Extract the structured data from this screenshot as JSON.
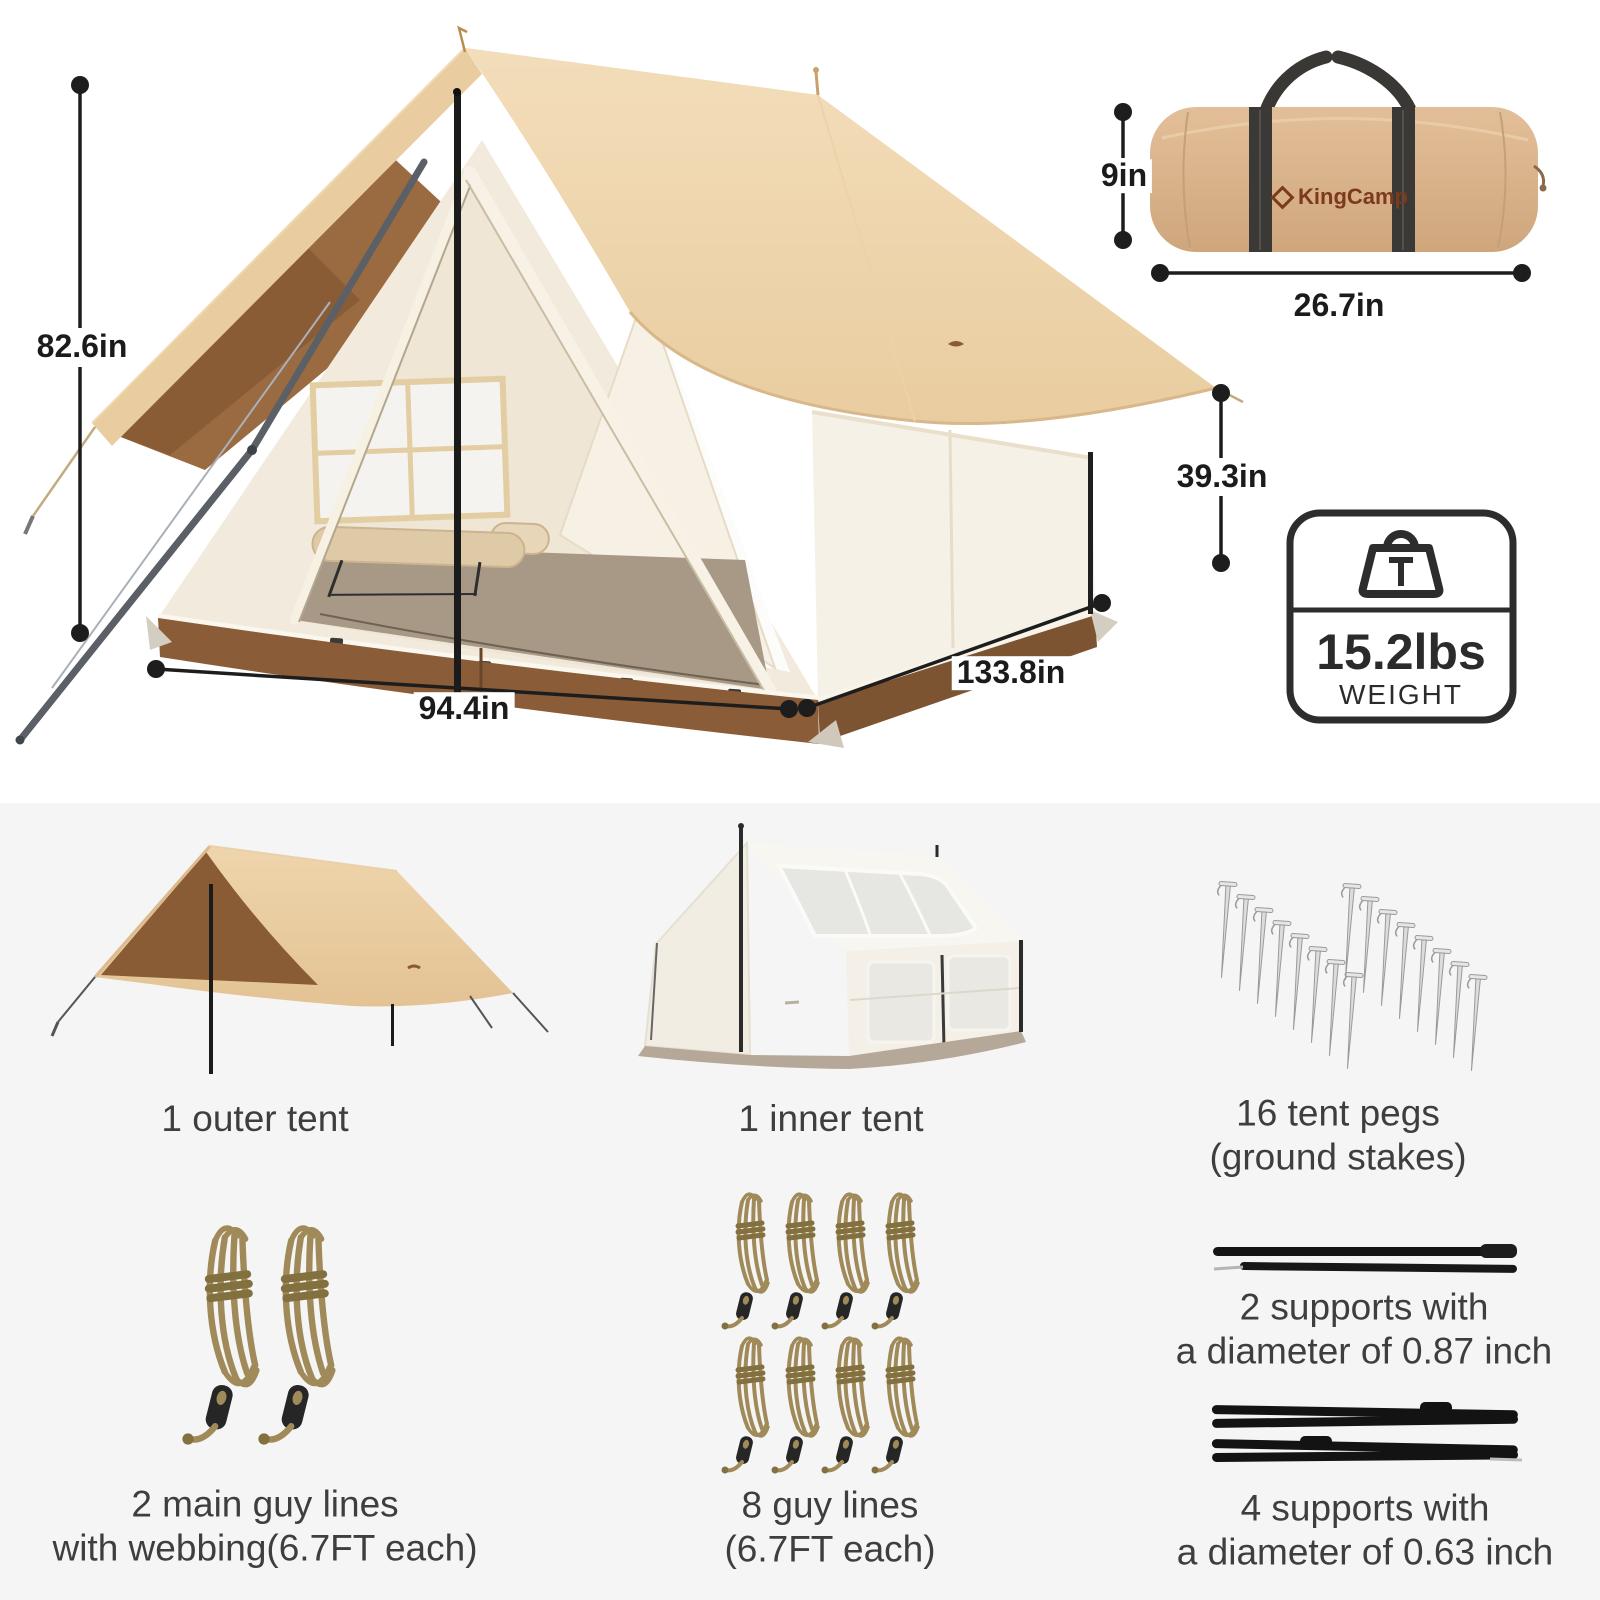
{
  "hero": {
    "dim_height": "82.6in",
    "dim_front_width": "94.4in",
    "dim_depth": "133.8in",
    "dim_side_height": "39.3in"
  },
  "bag": {
    "brand": "KingCamp",
    "dim_height": "9in",
    "dim_length": "26.7in"
  },
  "weight_badge": {
    "value": "15.2lbs",
    "label": "WEIGHT"
  },
  "components": {
    "outer_tent": {
      "label": "1 outer tent"
    },
    "inner_tent": {
      "label": "1 inner tent"
    },
    "tent_pegs": {
      "line1": "16 tent pegs",
      "line2": "(ground stakes)"
    },
    "main_guy_lines": {
      "line1": "2 main guy lines",
      "line2": "with webbing(6.7FT each)"
    },
    "guy_lines": {
      "line1": "8 guy lines",
      "line2": "(6.7FT each)"
    },
    "supports_large": {
      "line1": "2 supports with",
      "line2": "a diameter of 0.87 inch"
    },
    "supports_small": {
      "line1": "4 supports with",
      "line2": "a diameter of 0.63 inch"
    }
  },
  "colors": {
    "roof_tan": "#eed4ab",
    "underside_brown": "#9a6a40",
    "skirt_brown": "#8a5c38",
    "bag_tan": "#d9b28d",
    "logo_brown": "#7b3a1d",
    "dim_text": "#1b1b1b",
    "label_text": "#3e3e3e",
    "panel_gray": "#f5f5f6"
  }
}
